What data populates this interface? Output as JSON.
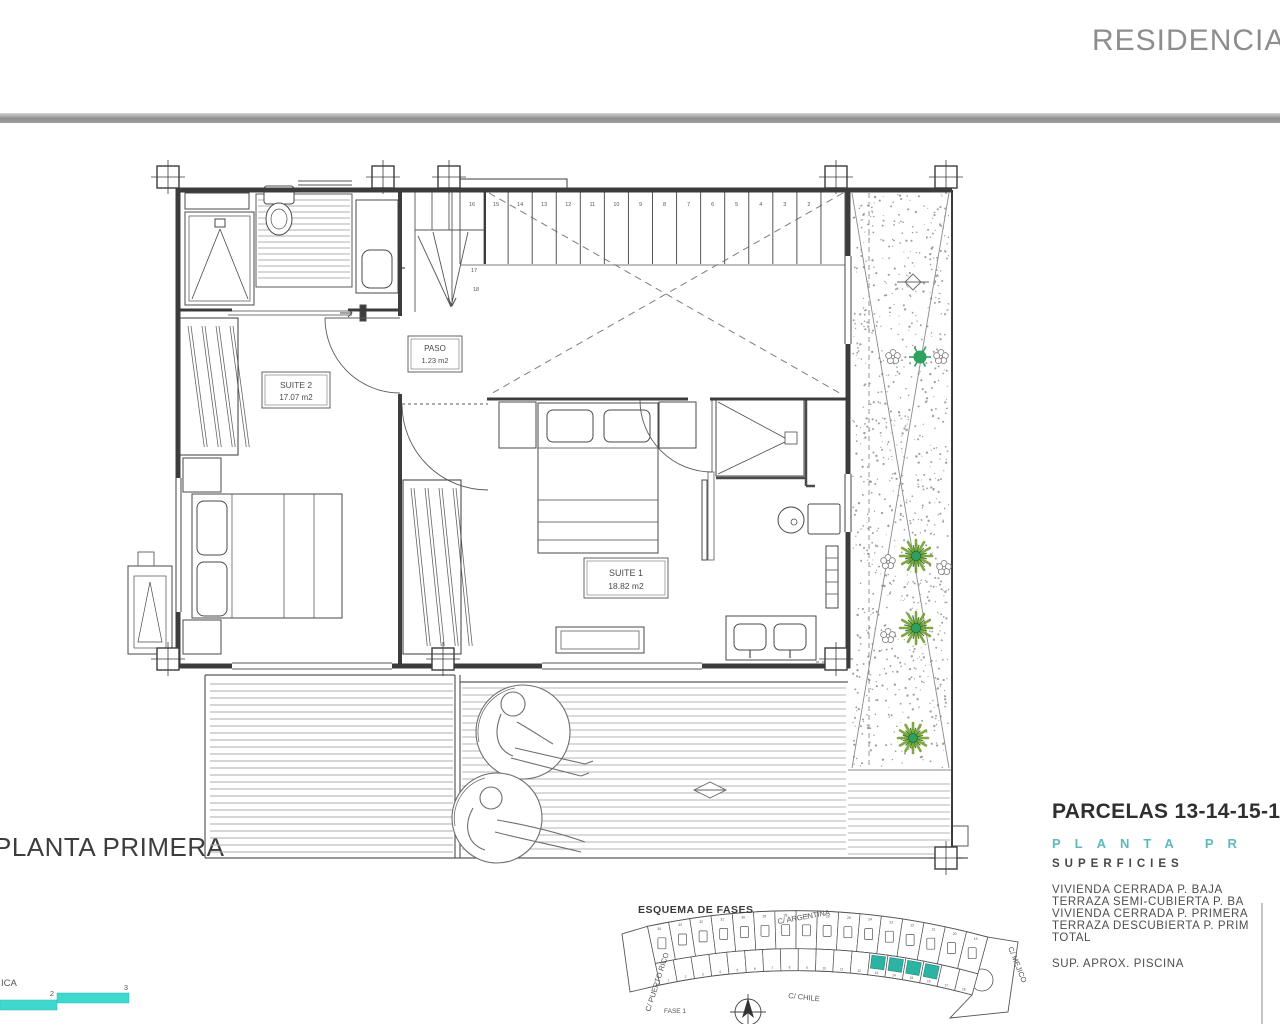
{
  "sheet": {
    "header_title": "RESIDENCIAL C",
    "plan_title": "PLANTA PRIMERA"
  },
  "plan": {
    "rooms": {
      "suite2": {
        "label": "SUITE 2",
        "area": "17.07 m2"
      },
      "paso": {
        "label": "PASO",
        "area": "1.23 m2"
      },
      "suite1": {
        "label": "SUITE 1",
        "area": "18.82 m2"
      }
    },
    "stairs": {
      "tread_numbers": [
        "16",
        "15",
        "14",
        "13",
        "12",
        "11",
        "10",
        "9",
        "8",
        "7",
        "6",
        "5",
        "4",
        "3",
        "2"
      ],
      "winder_numbers": [
        "17",
        "18"
      ]
    }
  },
  "scale_bar": {
    "caption": "ICA",
    "tick_labels": [
      "2",
      "3"
    ],
    "color": "#3fd8ce"
  },
  "esquema": {
    "title": "ESQUEMA DE FASES",
    "street_top": "C/ ARGENTINA",
    "street_left": "C/ PUERTO RICO",
    "street_bottom": "C/ CHILE",
    "street_right": "C/ MEJICO",
    "phase_label": "FASE 1",
    "top_parcels": [
      "34",
      "33",
      "32",
      "31",
      "30",
      "29",
      "28",
      "27",
      "26",
      "25",
      "24",
      "23",
      "22",
      "21",
      "20",
      "19"
    ],
    "bottom_parcels": [
      "1",
      "2",
      "3",
      "4",
      "5",
      "6",
      "7",
      "8",
      "9",
      "10",
      "11",
      "12",
      "13",
      "14",
      "15",
      "16",
      "17",
      "18"
    ],
    "highlighted": [
      "13",
      "14",
      "15",
      "16"
    ],
    "highlight_color": "#2db3a4"
  },
  "titleblock": {
    "parcelas_title": "PARCELAS 13-14-15-16",
    "planta_line": "PLANTA PR",
    "superficies_heading": "SUPERFICIES",
    "surface_rows": [
      "VIVIENDA CERRADA P. BAJA",
      "TERRAZA SEMI-CUBIERTA P. BA",
      "VIVIENDA CERRADA P. PRIMERA",
      "TERRAZA DESCUBIERTA P. PRIM",
      "TOTAL"
    ],
    "pool_row": "SUP. APROX. PISCINA"
  }
}
